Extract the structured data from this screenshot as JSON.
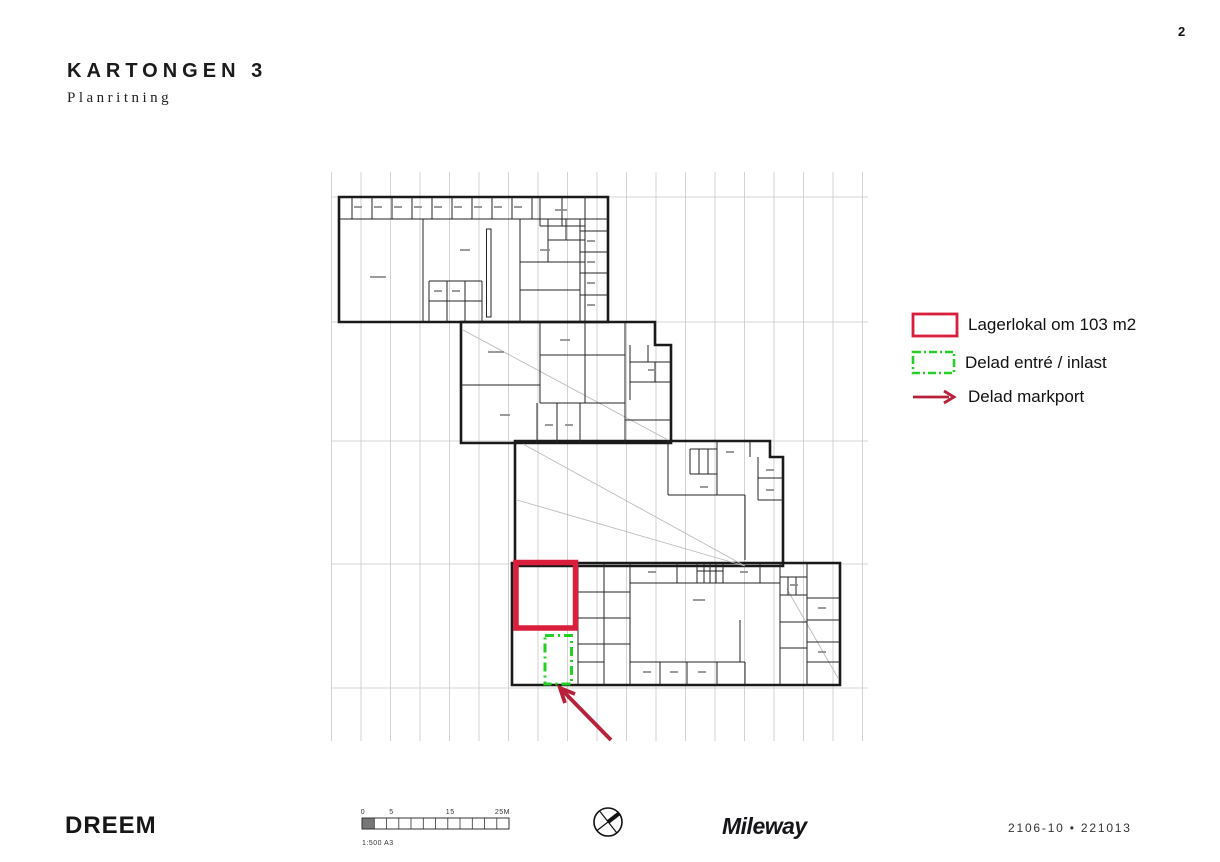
{
  "page": {
    "number": "2"
  },
  "header": {
    "title": "KARTONGEN 3",
    "subtitle": "Planritning"
  },
  "legend": {
    "items": [
      {
        "swatch": "red-outline-rect",
        "label": "Lagerlokal om 103 m2"
      },
      {
        "swatch": "green-dashdot-rect",
        "label": "Delad entré / inlast"
      },
      {
        "swatch": "red-arrow",
        "label": "Delad markport"
      }
    ]
  },
  "footer": {
    "brand_left": "DREEM",
    "scale_labels": [
      "0",
      "5",
      "15",
      "25M"
    ],
    "scale_text": "1:500 A3",
    "brand_right": "Mileway",
    "doc_ref": "2106-10 • 221013"
  },
  "colors": {
    "highlight_red": "#d91f3c",
    "highlight_green": "#26cf26",
    "arrow_red": "#b9203a",
    "plan_line": "#1a1a1a",
    "grid_line": "#c9c9c9"
  }
}
